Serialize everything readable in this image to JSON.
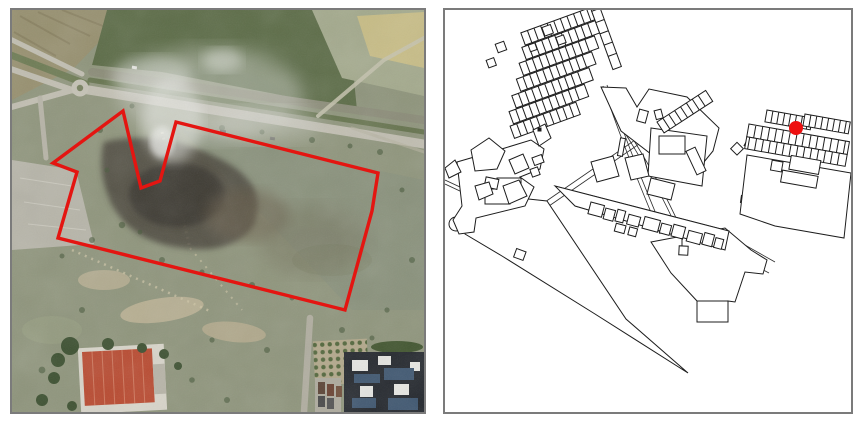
{
  "figure": {
    "background": "#ffffff",
    "panel_border_color": "#7b7b7b",
    "left_panel": {
      "id": "aerial-photo",
      "alt": "Aerial photograph of site with red boundary polygon and smoke over burned area",
      "boundary_color": "#e41511"
    },
    "right_panel": {
      "id": "building-footprint-map",
      "alt": "Building footprint map of settlement with red site location marker",
      "line_color": "#1d1d1d",
      "marker_color": "#ee1010",
      "marker_shape": "circle"
    }
  }
}
